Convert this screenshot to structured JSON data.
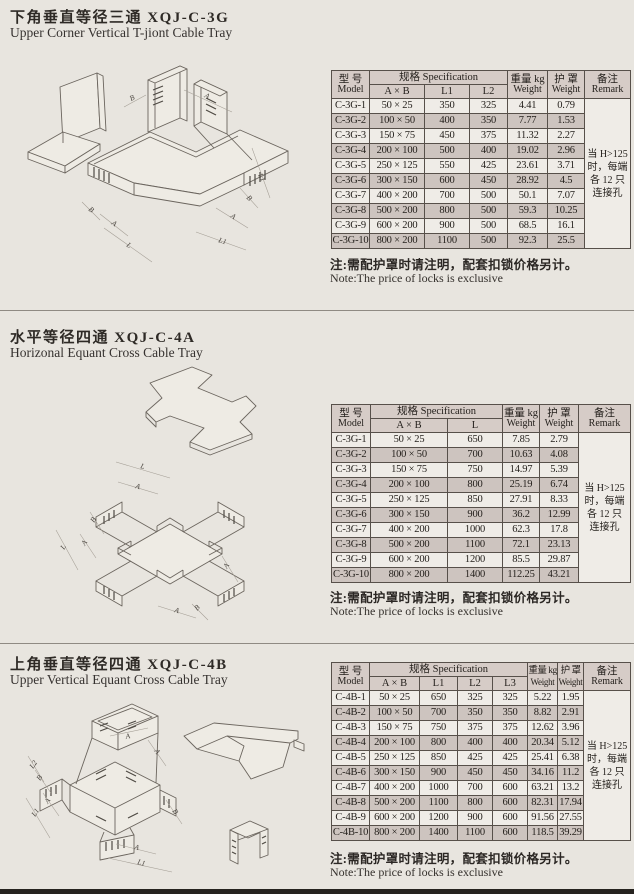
{
  "common": {
    "note_zh": "注:需配护罩时请注明，配套扣锁价格另计。",
    "note_en": "Note:The price of locks is exclusive",
    "remark": "当 H>125\n时，每端\n各 12 只\n连接孔"
  },
  "th": {
    "model_zh": "型 号",
    "model_en": "Model",
    "spec": "规格  Specification",
    "weight_zh": "重量 kg",
    "weight_en": "Weight",
    "cover_zh": "护 罩",
    "cover_en": "Weight",
    "remark_zh": "备注",
    "remark_en": "Remark"
  },
  "colors": {
    "paper": "#e8e5df",
    "table_header_bg": "#d6ccc7",
    "row_shade": "#cdc4bf",
    "row_light": "#efece7",
    "bottom_bar": "#26231f"
  },
  "sections": [
    {
      "title_zh": "下角垂直等径三通  XQJ-C-3G",
      "title_en": "Upper Corner Vertical T-jiont Cable Tray",
      "drawing": {
        "labels": [
          "B",
          "A",
          "L1",
          "B",
          "A",
          "B",
          "A",
          "L",
          "L1"
        ]
      },
      "table": {
        "spec_sub": [
          "A × B",
          "L1",
          "L2"
        ],
        "rows": [
          [
            "C-3G-1",
            "50 × 25",
            "350",
            "325",
            "4.41",
            "0.79"
          ],
          [
            "C-3G-2",
            "100 × 50",
            "400",
            "350",
            "7.77",
            "1.53"
          ],
          [
            "C-3G-3",
            "150 × 75",
            "450",
            "375",
            "11.32",
            "2.27"
          ],
          [
            "C-3G-4",
            "200 × 100",
            "500",
            "400",
            "19.02",
            "2.96"
          ],
          [
            "C-3G-5",
            "250 × 125",
            "550",
            "425",
            "23.61",
            "3.71"
          ],
          [
            "C-3G-6",
            "300 × 150",
            "600",
            "450",
            "28.92",
            "4.5"
          ],
          [
            "C-3G-7",
            "400 × 200",
            "700",
            "500",
            "50.1",
            "7.07"
          ],
          [
            "C-3G-8",
            "500 × 200",
            "800",
            "500",
            "59.3",
            "10.25"
          ],
          [
            "C-3G-9",
            "600 × 200",
            "900",
            "500",
            "68.5",
            "16.1"
          ],
          [
            "C-3G-10",
            "800 × 200",
            "1100",
            "500",
            "92.3",
            "25.5"
          ]
        ]
      }
    },
    {
      "title_zh": "水平等径四通  XQJ-C-4A",
      "title_en": "Horizonal Equant Cross Cable Tray",
      "drawing": {
        "labels": [
          "L",
          "A",
          "B",
          "A",
          "L",
          "A",
          "A",
          "B"
        ]
      },
      "table": {
        "spec_sub": [
          "A × B",
          "L"
        ],
        "rows": [
          [
            "C-3G-1",
            "50 × 25",
            "650",
            "7.85",
            "2.79"
          ],
          [
            "C-3G-2",
            "100 × 50",
            "700",
            "10.63",
            "4.08"
          ],
          [
            "C-3G-3",
            "150 × 75",
            "750",
            "14.97",
            "5.39"
          ],
          [
            "C-3G-4",
            "200 × 100",
            "800",
            "25.19",
            "6.74"
          ],
          [
            "C-3G-5",
            "250 × 125",
            "850",
            "27.91",
            "8.33"
          ],
          [
            "C-3G-6",
            "300 × 150",
            "900",
            "36.2",
            "12.99"
          ],
          [
            "C-3G-7",
            "400 × 200",
            "1000",
            "62.3",
            "17.8"
          ],
          [
            "C-3G-8",
            "500 × 200",
            "1100",
            "72.1",
            "23.13"
          ],
          [
            "C-3G-9",
            "600 × 200",
            "1200",
            "85.5",
            "29.87"
          ],
          [
            "C-3G-10",
            "800 × 200",
            "1400",
            "112.25",
            "43.21"
          ]
        ]
      }
    },
    {
      "title_zh": "上角垂直等径四通  XQJ-C-4B",
      "title_en": "Upper Vertical Equant Cross Cable Tray",
      "drawing": {
        "labels": [
          "A",
          "A",
          "L2",
          "B",
          "A",
          "L1",
          "B",
          "A",
          "L1"
        ]
      },
      "table": {
        "spec_sub": [
          "A × B",
          "L1",
          "L2",
          "L3"
        ],
        "rows": [
          [
            "C-4B-1",
            "50 × 25",
            "650",
            "325",
            "325",
            "5.22",
            "1.95"
          ],
          [
            "C-4B-2",
            "100 × 50",
            "700",
            "350",
            "350",
            "8.82",
            "2.91"
          ],
          [
            "C-4B-3",
            "150 × 75",
            "750",
            "375",
            "375",
            "12.62",
            "3.96"
          ],
          [
            "C-4B-4",
            "200 × 100",
            "800",
            "400",
            "400",
            "20.34",
            "5.12"
          ],
          [
            "C-4B-5",
            "250 × 125",
            "850",
            "425",
            "425",
            "25.41",
            "6.38"
          ],
          [
            "C-4B-6",
            "300 × 150",
            "900",
            "450",
            "450",
            "34.16",
            "11.2"
          ],
          [
            "C-4B-7",
            "400 × 200",
            "1000",
            "700",
            "600",
            "63.21",
            "13.2"
          ],
          [
            "C-4B-8",
            "500 × 200",
            "1100",
            "800",
            "600",
            "82.31",
            "17.94"
          ],
          [
            "C-4B-9",
            "600 × 200",
            "1200",
            "900",
            "600",
            "91.56",
            "27.55"
          ],
          [
            "C-4B-10",
            "800 × 200",
            "1400",
            "1100",
            "600",
            "118.5",
            "39.29"
          ]
        ]
      }
    }
  ]
}
